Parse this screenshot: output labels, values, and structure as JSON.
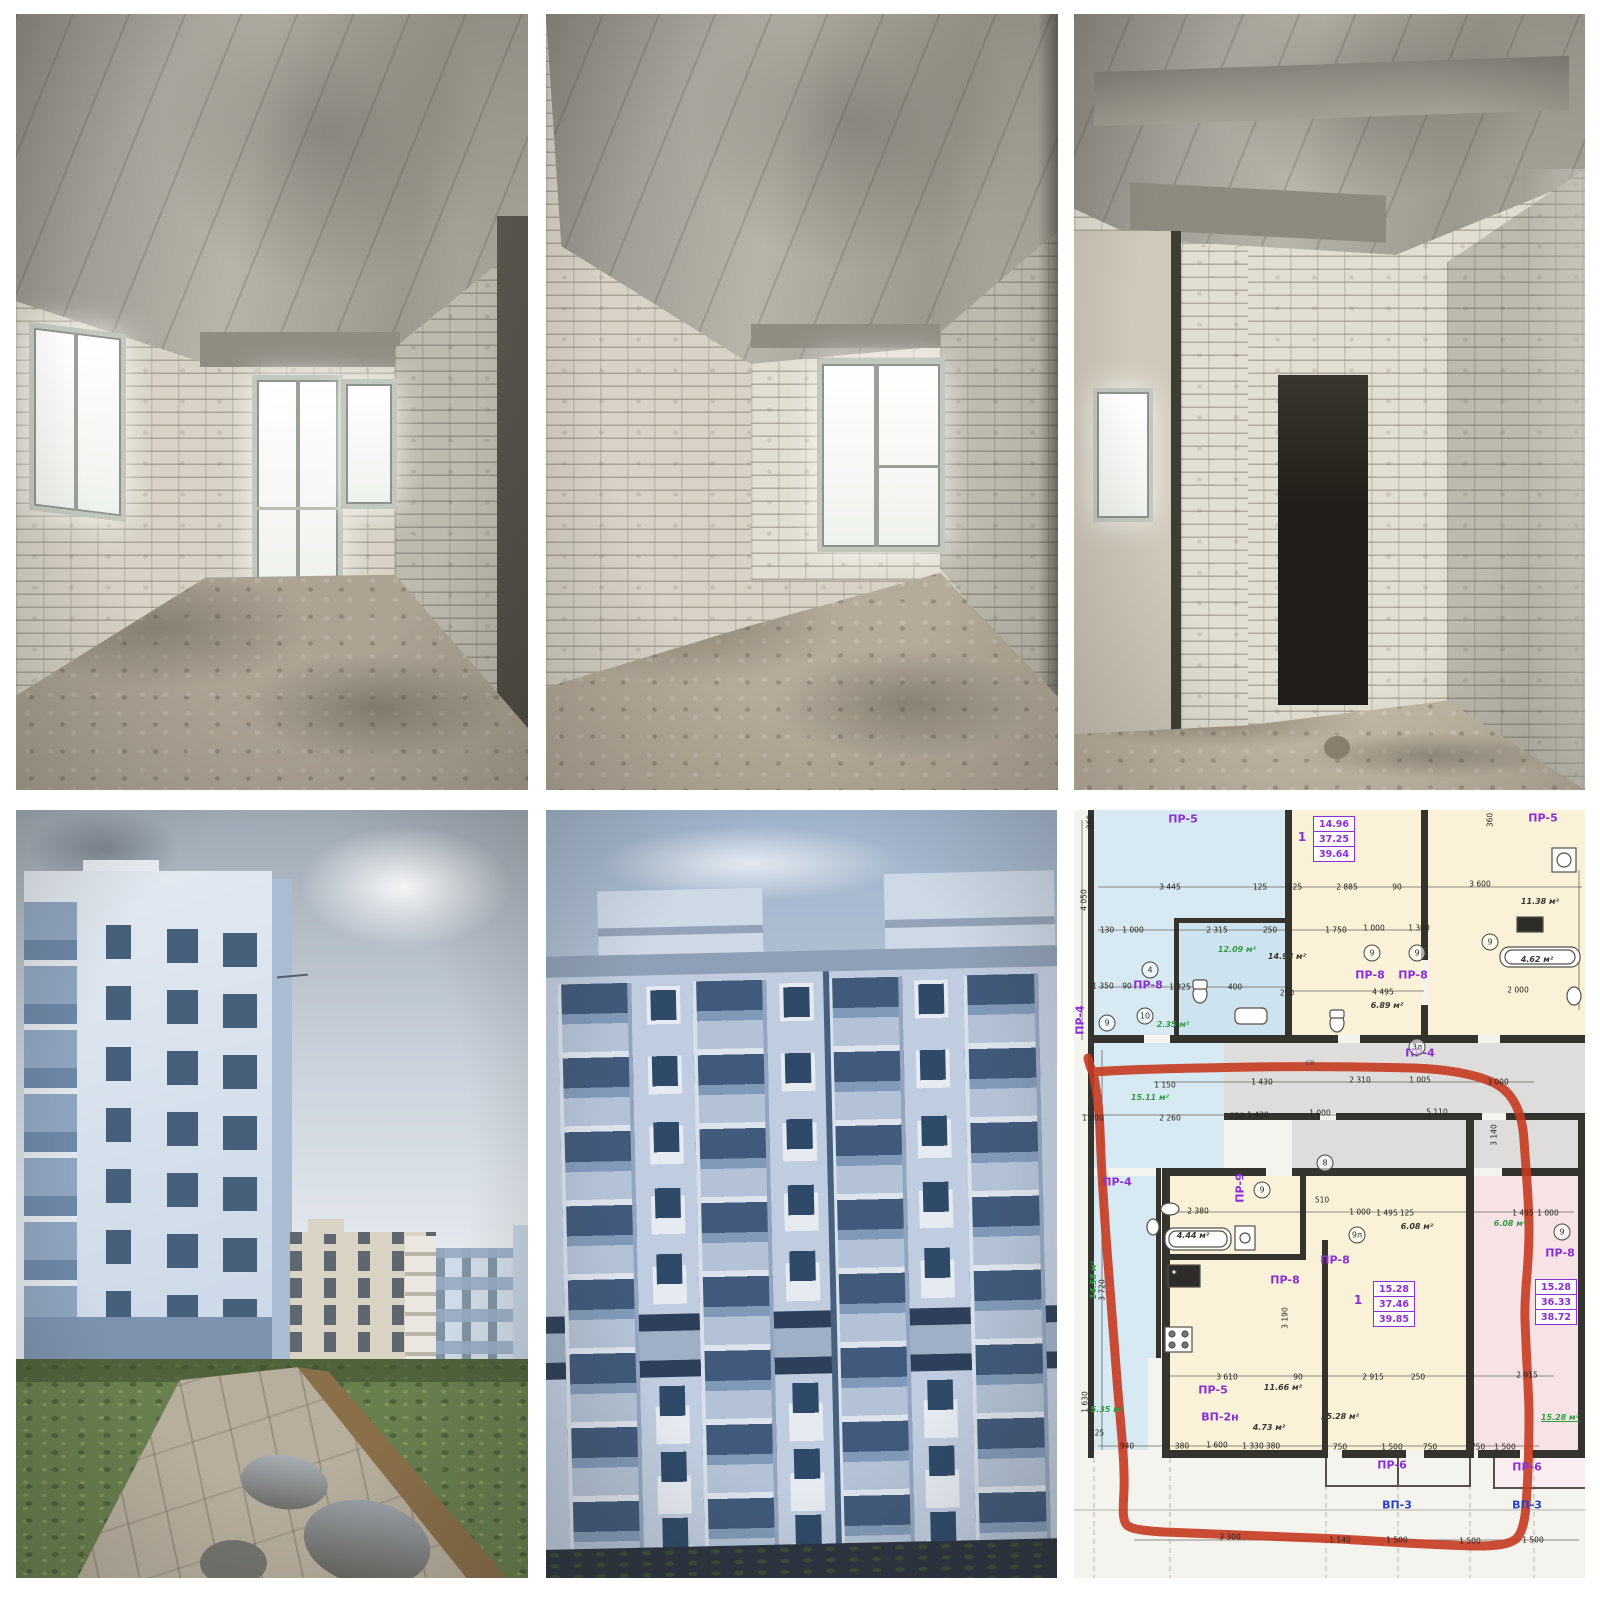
{
  "collage": {
    "rows": 2,
    "cols": 3,
    "background": "#ffffff"
  },
  "photos": {
    "top_left": "unfinished interior room, white brick walls, window and balcony door",
    "top_middle": "unfinished interior room, white brick walls, double window",
    "top_right": "unfinished interior corridor with dark doorway",
    "bottom_left": "new apartment buildings, grass and concrete path with puddles",
    "bottom_middle": "light blue apartment building facade with balconies",
    "bottom_right": "architectural floor plan with apartment outlined in red marker"
  },
  "floor_plan": {
    "background": "#f4f3ee",
    "colors": {
      "blue_room": "#d7e9f3",
      "cream_room": "#f9f2d9",
      "pink_room": "#f7e3e6",
      "corridor_gray": "#dedddb",
      "wall": "#35332d",
      "red_outline": "#c63a20",
      "purple_label": "#8b2fd6",
      "green_label": "#2f9e41",
      "blue_label": "#2743c9"
    },
    "apartment_boxes": [
      {
        "cx": 260,
        "cy": 29,
        "values": [
          "14.96",
          "37.25",
          "39.64"
        ]
      },
      {
        "cx": 320,
        "cy": 494,
        "values": [
          "15.28",
          "37.46",
          "39.85"
        ]
      },
      {
        "cx": 482,
        "cy": 492,
        "values": [
          "15.28",
          "36.33",
          "38.72"
        ]
      }
    ],
    "labels": [
      {
        "t": "ПР-5",
        "x": 109,
        "y": 9,
        "k": "room"
      },
      {
        "t": "ПР-5",
        "x": 469,
        "y": 8,
        "k": "room"
      },
      {
        "t": "ПР-8",
        "x": 74,
        "y": 175,
        "k": "room"
      },
      {
        "t": "ПР-8",
        "x": 296,
        "y": 165,
        "k": "room"
      },
      {
        "t": "ПР-8",
        "x": 339,
        "y": 165,
        "k": "room"
      },
      {
        "t": "ПР-4",
        "x": 346,
        "y": 243,
        "k": "room"
      },
      {
        "t": "ПР-4",
        "x": 43,
        "y": 372,
        "k": "room"
      },
      {
        "t": "ПР-9",
        "x": 166,
        "y": 378,
        "k": "room",
        "r": -90
      },
      {
        "t": "ПР-4",
        "x": 6,
        "y": 210,
        "k": "room",
        "r": -90
      },
      {
        "t": "ПР-8",
        "x": 261,
        "y": 450,
        "k": "room"
      },
      {
        "t": "ПР-8",
        "x": 211,
        "y": 470,
        "k": "room"
      },
      {
        "t": "ПР-8",
        "x": 486,
        "y": 443,
        "k": "room"
      },
      {
        "t": "ПР-5",
        "x": 139,
        "y": 580,
        "k": "room"
      },
      {
        "t": "ВП-2н",
        "x": 146,
        "y": 607,
        "k": "room"
      },
      {
        "t": "ПР-6",
        "x": 318,
        "y": 655,
        "k": "room"
      },
      {
        "t": "ПР-6",
        "x": 453,
        "y": 657,
        "k": "room"
      },
      {
        "t": "ВП-3",
        "x": 323,
        "y": 695,
        "k": "blue"
      },
      {
        "t": "ВП-3",
        "x": 453,
        "y": 695,
        "k": "blue"
      },
      {
        "t": "1",
        "x": 228,
        "y": 27,
        "k": "one"
      },
      {
        "t": "1",
        "x": 284,
        "y": 490,
        "k": "one"
      },
      {
        "t": "4",
        "x": 76,
        "y": 160,
        "k": "circ"
      },
      {
        "t": "9",
        "x": 33,
        "y": 213,
        "k": "circ"
      },
      {
        "t": "9",
        "x": 298,
        "y": 143,
        "k": "circ"
      },
      {
        "t": "9",
        "x": 343,
        "y": 143,
        "k": "circ"
      },
      {
        "t": "9",
        "x": 416,
        "y": 132,
        "k": "circ"
      },
      {
        "t": "3л",
        "x": 343,
        "y": 237,
        "k": "circ"
      },
      {
        "t": "10",
        "x": 71,
        "y": 206,
        "k": "circ"
      },
      {
        "t": "8",
        "x": 251,
        "y": 353,
        "k": "circ"
      },
      {
        "t": "9",
        "x": 188,
        "y": 380,
        "k": "circ"
      },
      {
        "t": "9л",
        "x": 283,
        "y": 425,
        "k": "circ"
      },
      {
        "t": "9",
        "x": 488,
        "y": 422,
        "k": "circ"
      },
      {
        "t": "14.98 м²",
        "x": 213,
        "y": 147,
        "k": "area"
      },
      {
        "t": "11.38 м²",
        "x": 466,
        "y": 92,
        "k": "area"
      },
      {
        "t": "4.62 м²",
        "x": 463,
        "y": 150,
        "k": "area"
      },
      {
        "t": "6.89 м²",
        "x": 313,
        "y": 196,
        "k": "area"
      },
      {
        "t": "6.08 м²",
        "x": 343,
        "y": 417,
        "k": "area"
      },
      {
        "t": "4.44 м²",
        "x": 119,
        "y": 426,
        "k": "area"
      },
      {
        "t": "11.66 м²",
        "x": 209,
        "y": 578,
        "k": "area"
      },
      {
        "t": "15.28 м²",
        "x": 266,
        "y": 607,
        "k": "area"
      },
      {
        "t": "4.73 м²",
        "x": 195,
        "y": 618,
        "k": "area"
      },
      {
        "t": "12.09 м²",
        "x": 163,
        "y": 140,
        "k": "green"
      },
      {
        "t": "2.35 м²",
        "x": 99,
        "y": 215,
        "k": "green"
      },
      {
        "t": "15.11 м²",
        "x": 76,
        "y": 288,
        "k": "green"
      },
      {
        "t": "14.58 м²",
        "x": 20,
        "y": 470,
        "k": "green",
        "r": -90
      },
      {
        "t": "5.35 м²",
        "x": 33,
        "y": 600,
        "k": "green"
      },
      {
        "t": "6.08 м²",
        "x": 436,
        "y": 414,
        "k": "green"
      },
      {
        "t": "15.28 м²",
        "x": 486,
        "y": 608,
        "k": "greenu"
      },
      {
        "t": "СВ",
        "x": 236,
        "y": 253,
        "k": "tiny"
      },
      {
        "t": "3 445",
        "x": 96,
        "y": 77,
        "k": "dim"
      },
      {
        "t": "125",
        "x": 186,
        "y": 77,
        "k": "dim"
      },
      {
        "t": "125",
        "x": 221,
        "y": 77,
        "k": "dim"
      },
      {
        "t": "2 885",
        "x": 273,
        "y": 77,
        "k": "dim"
      },
      {
        "t": "90",
        "x": 323,
        "y": 77,
        "k": "dim"
      },
      {
        "t": "3 600",
        "x": 406,
        "y": 74,
        "k": "dim"
      },
      {
        "t": "130",
        "x": 33,
        "y": 120,
        "k": "dim"
      },
      {
        "t": "1 000",
        "x": 59,
        "y": 120,
        "k": "dim"
      },
      {
        "t": "2 315",
        "x": 143,
        "y": 120,
        "k": "dim"
      },
      {
        "t": "250",
        "x": 196,
        "y": 120,
        "k": "dim"
      },
      {
        "t": "1 750",
        "x": 262,
        "y": 120,
        "k": "dim"
      },
      {
        "t": "1 000",
        "x": 300,
        "y": 118,
        "k": "dim"
      },
      {
        "t": "1 300",
        "x": 345,
        "y": 118,
        "k": "dim"
      },
      {
        "t": "4 050",
        "x": 10,
        "y": 90,
        "k": "dim",
        "r": -90
      },
      {
        "t": "360",
        "x": 16,
        "y": 12,
        "k": "dim",
        "r": -90
      },
      {
        "t": "360",
        "x": 416,
        "y": 10,
        "k": "dim",
        "r": -90
      },
      {
        "t": "1 350",
        "x": 29,
        "y": 176,
        "k": "dim"
      },
      {
        "t": "90",
        "x": 53,
        "y": 176,
        "k": "dim"
      },
      {
        "t": "1 325",
        "x": 106,
        "y": 177,
        "k": "dim"
      },
      {
        "t": "400",
        "x": 161,
        "y": 177,
        "k": "dim"
      },
      {
        "t": "2 000",
        "x": 444,
        "y": 180,
        "k": "dim"
      },
      {
        "t": "250",
        "x": 213,
        "y": 183,
        "k": "dim"
      },
      {
        "t": "4 495",
        "x": 309,
        "y": 182,
        "k": "dim"
      },
      {
        "t": "1 150",
        "x": 91,
        "y": 275,
        "k": "dim"
      },
      {
        "t": "1 430",
        "x": 188,
        "y": 272,
        "k": "dim"
      },
      {
        "t": "2 310",
        "x": 286,
        "y": 270,
        "k": "dim"
      },
      {
        "t": "1 005",
        "x": 346,
        "y": 270,
        "k": "dim"
      },
      {
        "t": "3 000",
        "x": 424,
        "y": 272,
        "k": "dim"
      },
      {
        "t": "1 000",
        "x": 19,
        "y": 308,
        "k": "dim"
      },
      {
        "t": "2 260",
        "x": 96,
        "y": 308,
        "k": "dim"
      },
      {
        "t": "250",
        "x": 163,
        "y": 306,
        "k": "dim"
      },
      {
        "t": "1 420",
        "x": 184,
        "y": 305,
        "k": "dim"
      },
      {
        "t": "1 000",
        "x": 246,
        "y": 303,
        "k": "dim"
      },
      {
        "t": "5 110",
        "x": 363,
        "y": 302,
        "k": "dim"
      },
      {
        "t": "3 140",
        "x": 420,
        "y": 325,
        "k": "dim",
        "r": -90
      },
      {
        "t": "2 380",
        "x": 124,
        "y": 401,
        "k": "dim"
      },
      {
        "t": "510",
        "x": 248,
        "y": 390,
        "k": "dim"
      },
      {
        "t": "1 000",
        "x": 286,
        "y": 402,
        "k": "dim"
      },
      {
        "t": "1 495",
        "x": 313,
        "y": 403,
        "k": "dim"
      },
      {
        "t": "125",
        "x": 333,
        "y": 403,
        "k": "dim"
      },
      {
        "t": "1 495",
        "x": 449,
        "y": 403,
        "k": "dim"
      },
      {
        "t": "1 000",
        "x": 474,
        "y": 403,
        "k": "dim"
      },
      {
        "t": "3 720",
        "x": 28,
        "y": 480,
        "k": "dim",
        "r": -90
      },
      {
        "t": "3 190",
        "x": 211,
        "y": 508,
        "k": "dim",
        "r": -90
      },
      {
        "t": "3 610",
        "x": 153,
        "y": 567,
        "k": "dim"
      },
      {
        "t": "90",
        "x": 224,
        "y": 567,
        "k": "dim"
      },
      {
        "t": "2 915",
        "x": 299,
        "y": 567,
        "k": "dim"
      },
      {
        "t": "250",
        "x": 344,
        "y": 567,
        "k": "dim"
      },
      {
        "t": "2 915",
        "x": 453,
        "y": 565,
        "k": "dim"
      },
      {
        "t": "940",
        "x": 53,
        "y": 636,
        "k": "dim"
      },
      {
        "t": "380",
        "x": 108,
        "y": 636,
        "k": "dim"
      },
      {
        "t": "1 600",
        "x": 143,
        "y": 635,
        "k": "dim"
      },
      {
        "t": "1 330",
        "x": 179,
        "y": 636,
        "k": "dim"
      },
      {
        "t": "380",
        "x": 199,
        "y": 636,
        "k": "dim"
      },
      {
        "t": "750",
        "x": 266,
        "y": 637,
        "k": "dim"
      },
      {
        "t": "1 500",
        "x": 318,
        "y": 637,
        "k": "dim"
      },
      {
        "t": "750",
        "x": 356,
        "y": 637,
        "k": "dim"
      },
      {
        "t": "750",
        "x": 404,
        "y": 637,
        "k": "dim"
      },
      {
        "t": "1 500",
        "x": 431,
        "y": 637,
        "k": "dim"
      },
      {
        "t": "3 300",
        "x": 156,
        "y": 727,
        "k": "dim"
      },
      {
        "t": "1 140",
        "x": 266,
        "y": 730,
        "k": "dim"
      },
      {
        "t": "1 500",
        "x": 323,
        "y": 730,
        "k": "dim"
      },
      {
        "t": "1 500",
        "x": 396,
        "y": 731,
        "k": "dim"
      },
      {
        "t": "1 500",
        "x": 459,
        "y": 730,
        "k": "dim"
      },
      {
        "t": "1 630",
        "x": 11,
        "y": 592,
        "k": "dim",
        "r": -90
      },
      {
        "t": "125",
        "x": 23,
        "y": 623,
        "k": "dim"
      }
    ]
  }
}
